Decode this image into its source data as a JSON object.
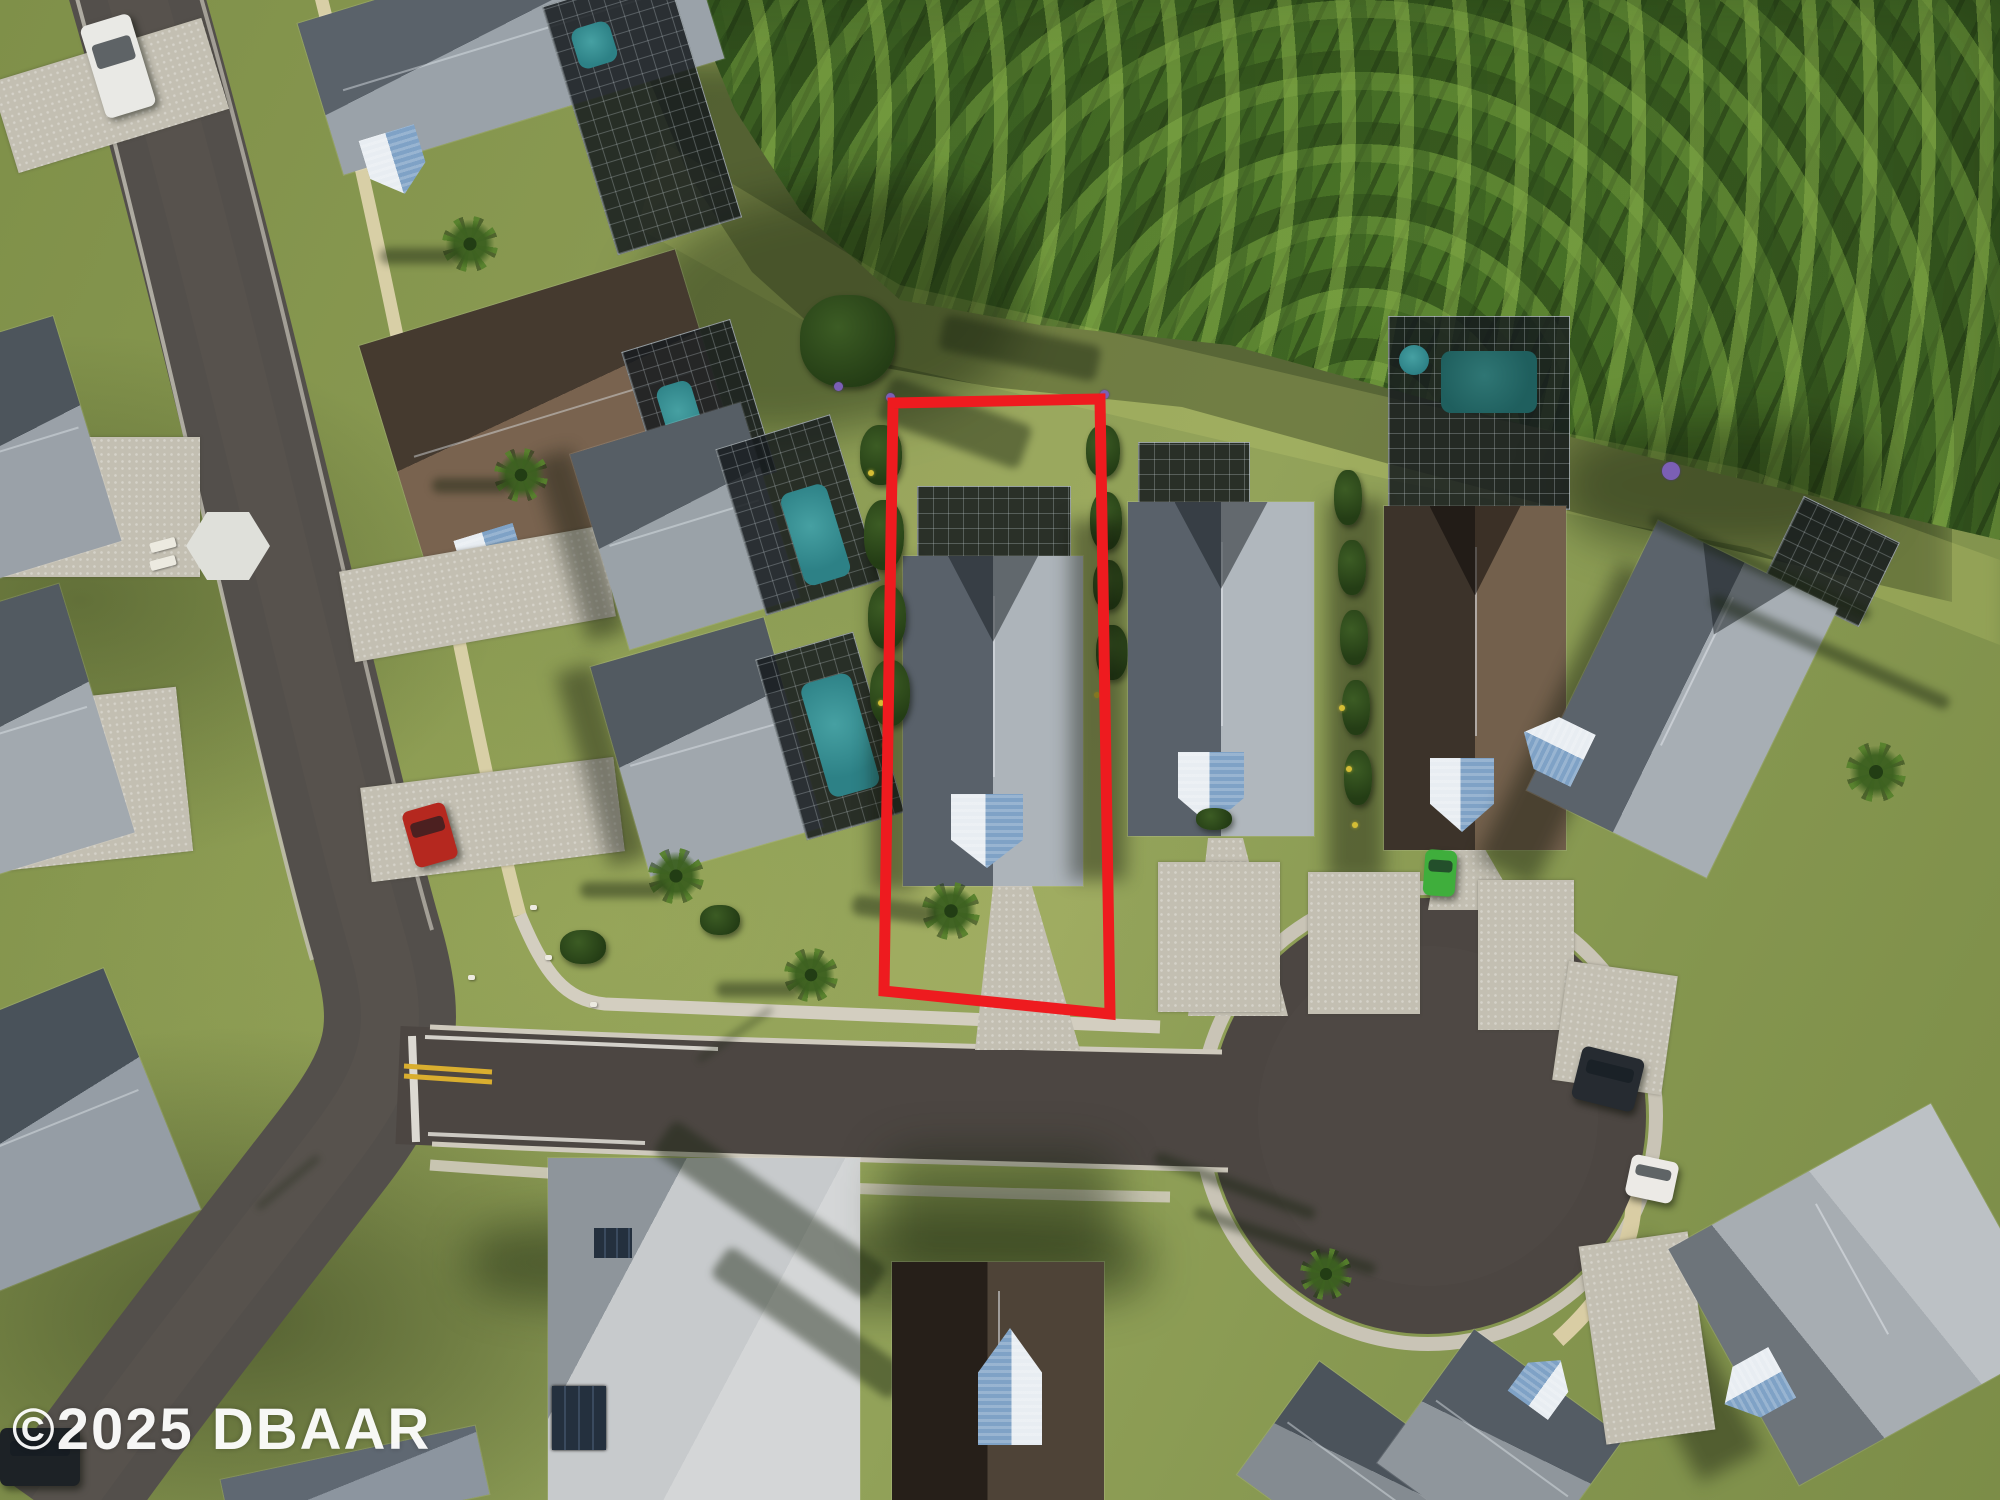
{
  "image": {
    "type": "aerial-drone-photo",
    "subject": "residential neighborhood with highlighted vacant-style lot and cul-de-sac"
  },
  "watermark": {
    "text": "©2025 DBAAR",
    "color": "#ffffff"
  },
  "highlight": {
    "name": "property-boundary-outline",
    "color": "#ee1b1f",
    "stroke_width": "11",
    "points": "893,403 1100,399 1110,1014 884,991"
  },
  "palette": {
    "grass": "#87974f",
    "asphalt_road": "#534f4b",
    "asphalt_street": "#4c4642",
    "concrete_sidewalk": "#d3cec0",
    "tan_path": "#d8cfa6",
    "paver_driveway": "#c3bfb2",
    "roof_gray_lit": "#adb4ba",
    "roof_gray_shade": "#59616a",
    "roof_brown": "#73604c",
    "roof_light": "#c7cacc",
    "metal_gable_blue": "#7fa2c6",
    "pool_teal": "#2d8186",
    "forest_green": "#33511f",
    "lane_yellow": "#d9ae2f",
    "lane_white": "#eceae2"
  },
  "vehicles": [
    {
      "name": "white-pickup-truck",
      "color": "#e9e9e5"
    },
    {
      "name": "red-car",
      "color": "#b5281f"
    },
    {
      "name": "green-sports-car",
      "color": "#3fae3c"
    },
    {
      "name": "dark-suv",
      "color": "#262b31"
    },
    {
      "name": "white-car",
      "color": "#eceae6"
    }
  ]
}
